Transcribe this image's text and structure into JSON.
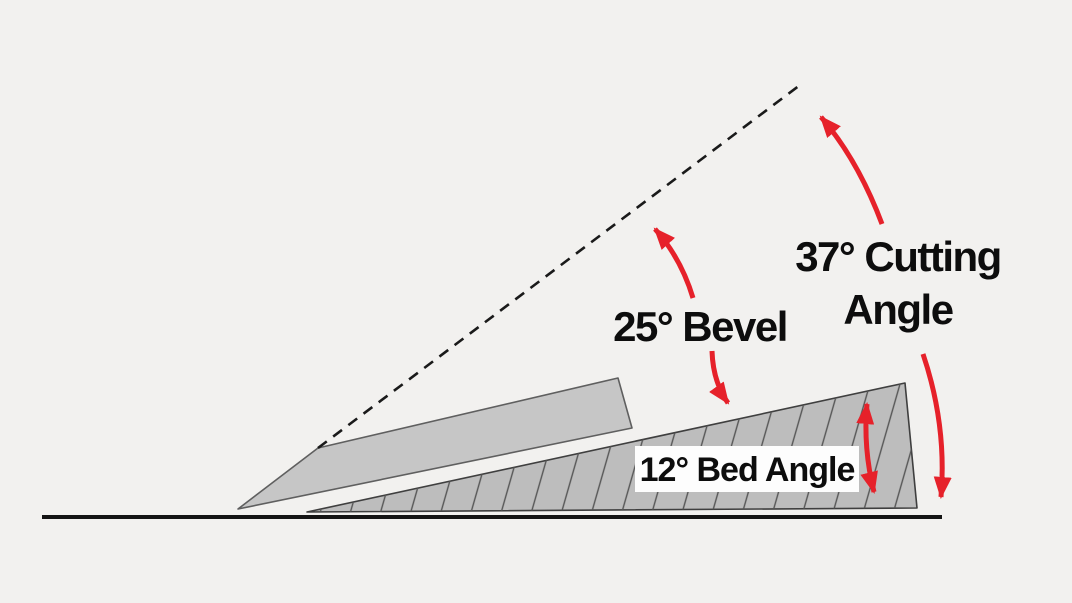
{
  "labels": {
    "bevel": "25° Bevel",
    "cutting_line1": "37° Cutting",
    "cutting_line2": "Angle",
    "bed": "12° Bed Angle"
  },
  "angles": {
    "bevel_deg": 25,
    "cutting_deg": 37,
    "bed_deg": 12
  },
  "colors": {
    "background": "#f2f1ef",
    "blade_fill": "#c6c6c6",
    "blade_stroke": "#5f5f5f",
    "bed_fill": "#bdbdbd",
    "bed_stroke": "#3f3f3f",
    "hatch": "#555555",
    "ground": "#141414",
    "arrow_red": "#e6212a",
    "text": "#0d0d0d",
    "label_box": "#fdfdfd",
    "dashed_line": "#1a1a1a"
  }
}
